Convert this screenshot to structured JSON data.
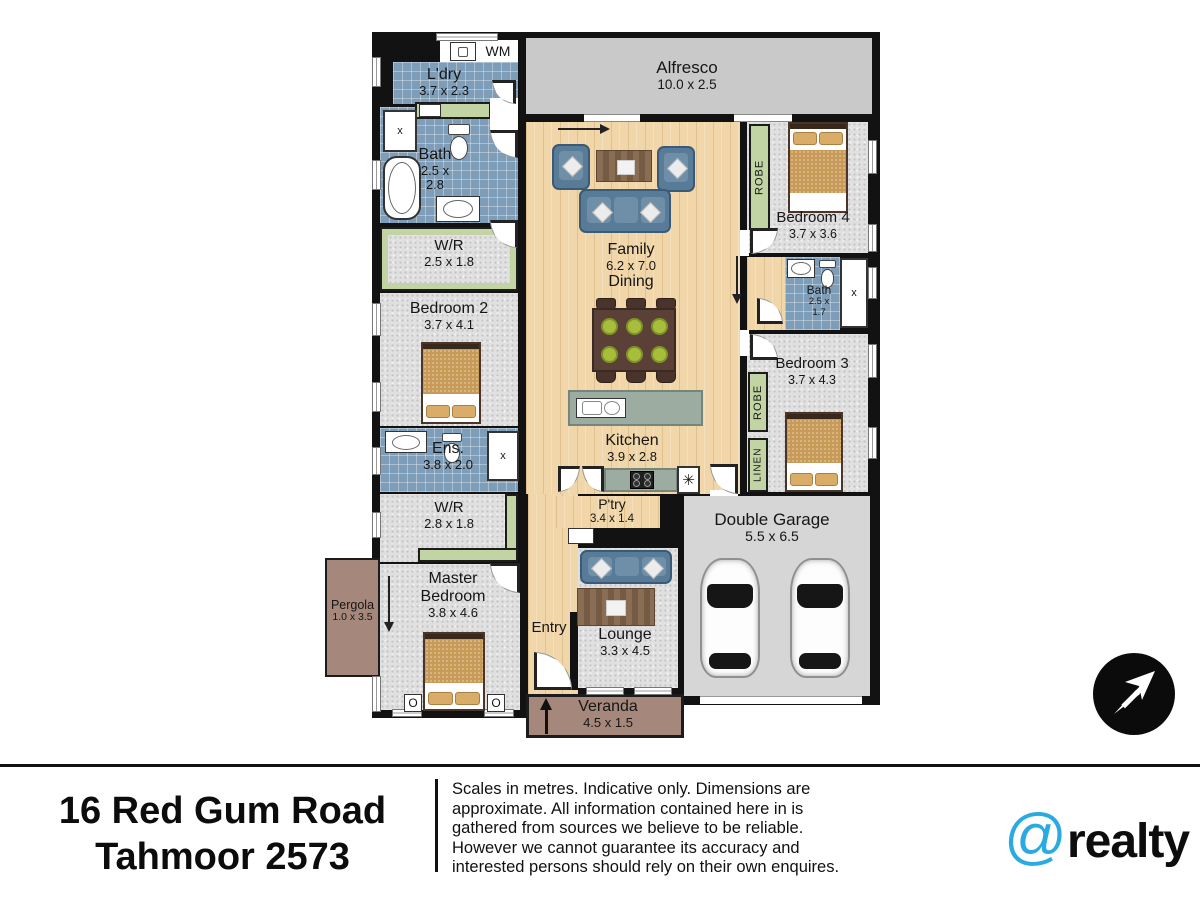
{
  "floorplan": {
    "rooms": {
      "ldry": {
        "name": "L'dry",
        "dims": "3.7 x 2.3"
      },
      "bath1": {
        "name": "Bath",
        "d1": "2.5 x",
        "d2": "2.8"
      },
      "wr1": {
        "name": "W/R",
        "dims": "2.5 x 1.8"
      },
      "bed2": {
        "name": "Bedroom 2",
        "dims": "3.7 x 4.1"
      },
      "ens": {
        "name": "Ens.",
        "dims": "3.8 x 2.0"
      },
      "wr2": {
        "name": "W/R",
        "dims": "2.8 x 1.8"
      },
      "master": {
        "n1": "Master",
        "n2": "Bedroom",
        "dims": "3.8 x 4.6"
      },
      "pergola": {
        "name": "Pergola",
        "dims": "1.0 x 3.5"
      },
      "alfresco": {
        "name": "Alfresco",
        "dims": "10.0 x 2.5"
      },
      "family": {
        "name": "Family",
        "dims": "6.2 x 7.0",
        "name2": "Dining"
      },
      "kitchen": {
        "name": "Kitchen",
        "dims": "3.9 x 2.8"
      },
      "ptry": {
        "name": "P'try",
        "dims": "3.4 x 1.4"
      },
      "entry": {
        "name": "Entry"
      },
      "lounge": {
        "name": "Lounge",
        "dims": "3.3 x 4.5"
      },
      "veranda": {
        "name": "Veranda",
        "dims": "4.5 x 1.5"
      },
      "garage": {
        "name": "Double Garage",
        "dims": "5.5 x 6.5"
      },
      "bed4": {
        "name": "Bedroom 4",
        "dims": "3.7 x 3.6"
      },
      "bath2": {
        "name": "Bath",
        "d1": "2.5 x",
        "d2": "1.7"
      },
      "bed3": {
        "name": "Bedroom 3",
        "dims": "3.7 x 4.3"
      }
    },
    "tags": {
      "wm": "WM",
      "robe": "ROBE",
      "linen": "LINEN",
      "shower": "x",
      "appliance": "✳",
      "lamp": "O"
    }
  },
  "footer": {
    "address_line1": "16 Red Gum Road",
    "address_line2": "Tahmoor 2573",
    "disclaimer": "Scales in metres. Indicative only. Dimensions are approximate. All information contained here in is gathered from sources we believe to be reliable. However we cannot guarantee its accuracy and interested persons should rely on their own enquires.",
    "brand": {
      "at": "@",
      "name": "realty",
      "accent": "#29abe2"
    }
  }
}
